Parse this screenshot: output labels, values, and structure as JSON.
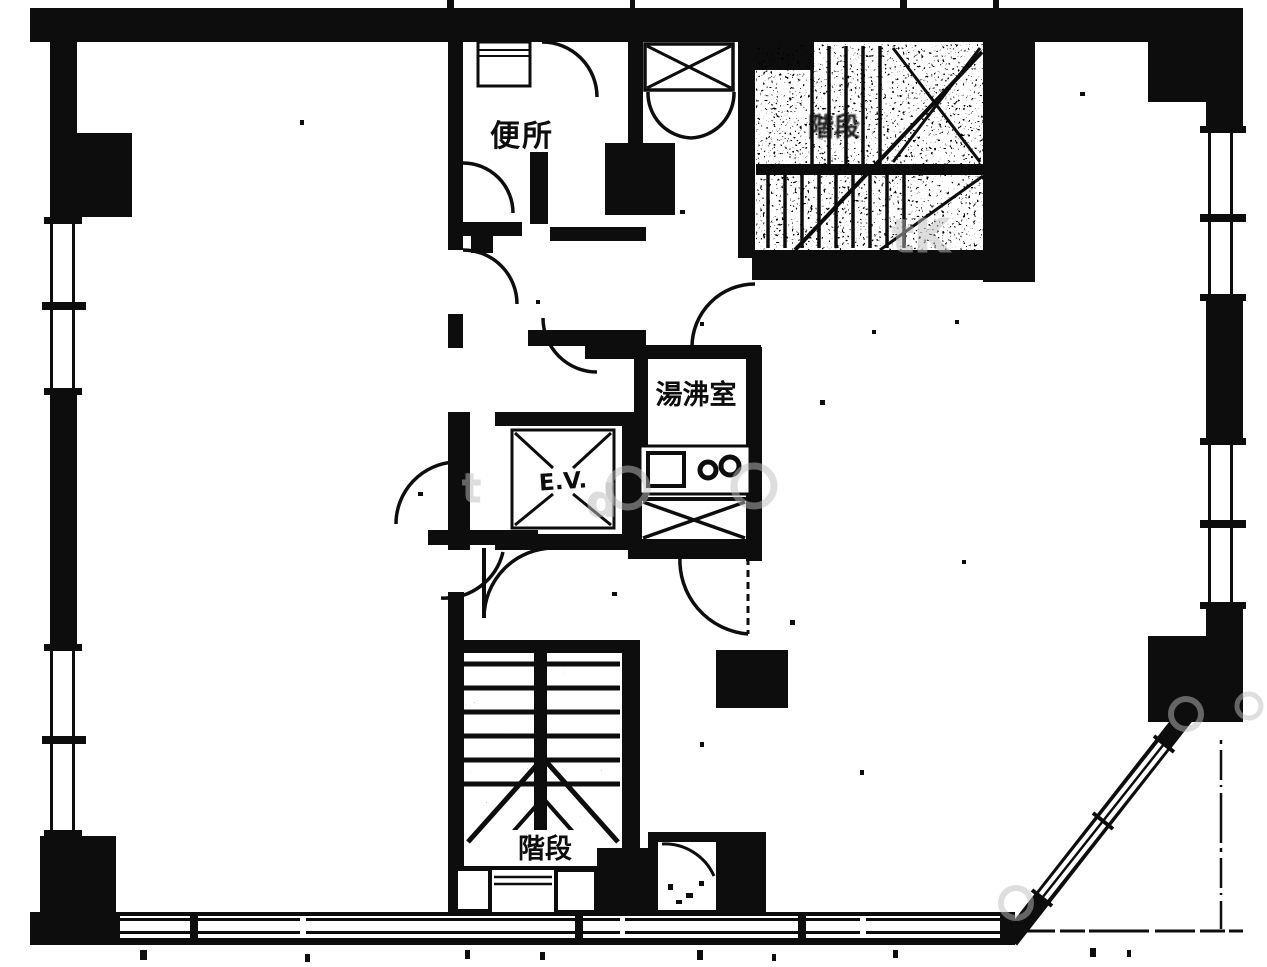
{
  "plan": {
    "rooms": {
      "toilet": "便所",
      "kitchenette": "湯沸室",
      "elevator": "E.V.",
      "stairs": "階段",
      "stairs_upper": "階段"
    },
    "watermarks": {
      "tk": "tK",
      "t": "t",
      "d": "d"
    },
    "colors": {
      "ink": "#0d0d0d",
      "paper": "#ffffff",
      "watermark": "#bdbdbd"
    }
  }
}
